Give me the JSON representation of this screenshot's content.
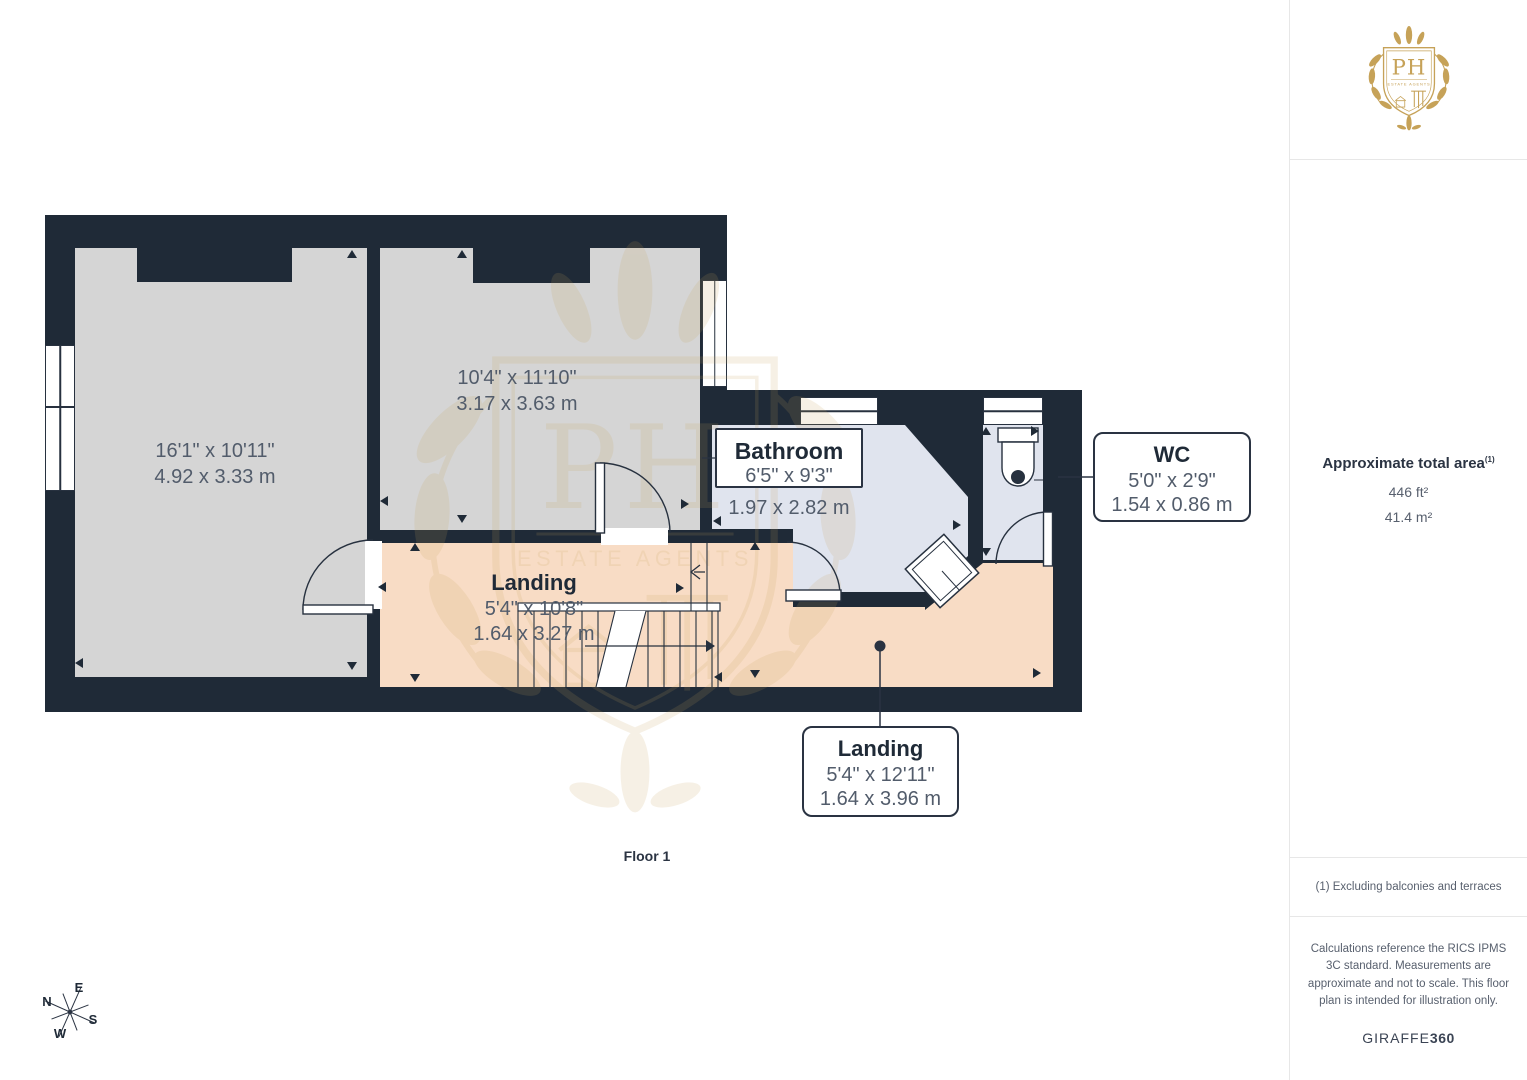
{
  "plan": {
    "floor_label": "Floor 1",
    "colors": {
      "wall": "#1f2a37",
      "room_gray": "#d5d5d5",
      "landing_peach": "#f8dcc5",
      "bath_blue": "#e0e4ee",
      "linework": "#27313f",
      "label_gray": "#525c6b"
    },
    "rooms": [
      {
        "id": "room-left",
        "dims_imperial": "16'1\" x 10'11\"",
        "dims_metric": "4.92 x 3.33 m"
      },
      {
        "id": "room-mid",
        "dims_imperial": "10'4\" x 11'10\"",
        "dims_metric": "3.17 x 3.63 m"
      },
      {
        "id": "bathroom",
        "name": "Bathroom",
        "dims_imperial": "6'5\" x 9'3\"",
        "dims_metric": "1.97 x 2.82 m"
      },
      {
        "id": "landing",
        "name": "Landing",
        "dims_imperial": "5'4\" x 10'8\"",
        "dims_metric": "1.64 x 3.27 m"
      },
      {
        "id": "wc",
        "name": "WC",
        "dims_imperial": "5'0\" x 2'9\"",
        "dims_metric": "1.54 x 0.86 m"
      },
      {
        "id": "landing-below",
        "name": "Landing",
        "dims_imperial": "5'4\" x 12'11\"",
        "dims_metric": "1.64 x 3.96 m"
      }
    ],
    "compass": {
      "n": "N",
      "e": "E",
      "s": "S",
      "w": "W"
    }
  },
  "sidebar": {
    "logo": {
      "monogram": "PH",
      "subtext": "ESTATE AGENTS"
    },
    "gold": "#c6a258",
    "area": {
      "title": "Approximate total area",
      "sup": "(1)",
      "imperial": "446 ft²",
      "metric": "41.4 m²"
    },
    "footnote": "(1) Excluding balconies and terraces",
    "legal": "Calculations reference the RICS IPMS 3C standard. Measurements are approximate and not to scale. This floor plan is intended for illustration only.",
    "brand": {
      "name": "GIRAFFE",
      "suffix": "360"
    }
  }
}
